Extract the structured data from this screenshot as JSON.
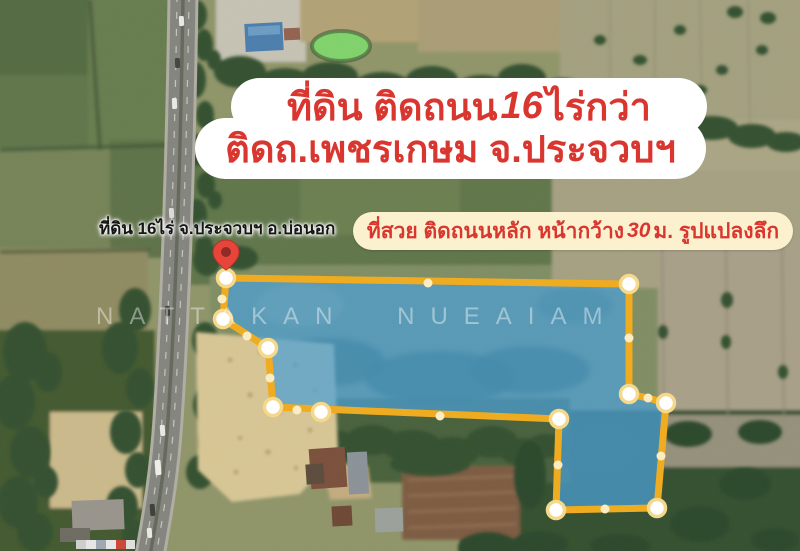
{
  "headline_banner": {
    "line1_prefix": "ที่ดิน ติดถนน ",
    "line1_number": "16",
    "line1_suffix": " ไร่กว่า",
    "line2": "ติดถ.เพชรเกษม  จ.ประจวบฯ"
  },
  "pin_label": {
    "text": "ที่ดิน 16ไร่ จ.ประจวบฯ อ.บ่อนอก"
  },
  "feature_banner": {
    "prefix": "ที่สวย ติดถนนหลัก  หน้ากว้าง ",
    "number": "30",
    "suffix": " ม.  รูปแปลงลึก"
  },
  "watermark": {
    "text": "NATTAKAN NUEAIAM"
  },
  "colors": {
    "banner_text_red": "#d9362f",
    "banner_main_bg": "#ffffff",
    "banner_secondary_bg": "#fbf1cf",
    "plot_fill_blue": "#4b9fd6",
    "plot_border_yellow": "#f0ac21",
    "pin_red": "#e8453a",
    "pin_inner": "#8f2b26",
    "label_text": "#161616"
  },
  "plot_overlay": {
    "outline": [
      [
        226,
        278
      ],
      [
        629,
        284
      ],
      [
        629,
        394
      ],
      [
        648,
        398
      ],
      [
        666,
        403
      ],
      [
        657,
        508
      ],
      [
        556,
        510
      ],
      [
        559,
        419
      ],
      [
        273,
        407
      ],
      [
        268,
        348
      ],
      [
        223,
        319
      ]
    ],
    "vertex_dots": [
      [
        226,
        278
      ],
      [
        629,
        284
      ],
      [
        629,
        394
      ],
      [
        666,
        403
      ],
      [
        657,
        508
      ],
      [
        556,
        510
      ],
      [
        559,
        419
      ],
      [
        273,
        407
      ],
      [
        268,
        348
      ],
      [
        223,
        319
      ],
      [
        321,
        412
      ]
    ],
    "edge_dots": [
      [
        428,
        283
      ],
      [
        629,
        338
      ],
      [
        648,
        398
      ],
      [
        661,
        456
      ],
      [
        605,
        509
      ],
      [
        558,
        465
      ],
      [
        440,
        416
      ],
      [
        297,
        410
      ],
      [
        270,
        378
      ],
      [
        247,
        336
      ],
      [
        222,
        299
      ]
    ],
    "pin": {
      "x": 226,
      "y": 270
    }
  }
}
